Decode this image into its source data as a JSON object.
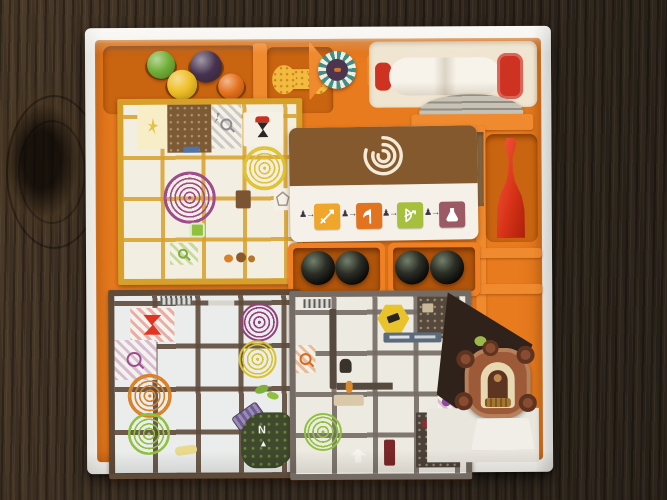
{
  "scene": {
    "description": "Magic Maze board game box interior with orange plastic insert, sitting on a dark wood table",
    "table_colors": {
      "base": "#3c3023",
      "grain_dark": "#221a13",
      "grain_light": "#4c3b29"
    },
    "box_colors": {
      "rim": "#f5f3ee",
      "floor": "#e9e6de"
    },
    "insert_colors": {
      "base": "#e87b1e",
      "wall": "#f08a2e",
      "recess": "#c96410"
    }
  },
  "inventory": {
    "hero_pawns": [
      "green",
      "purple",
      "yellow",
      "orange"
    ],
    "tokens": [
      "bone-shaped token",
      "striped round token",
      "stack of grey discs",
      "4 black dome tokens"
    ],
    "timer": "large sand timer with red caps",
    "large_pawn": "red wooden pawn",
    "card": "vortex card with four hero-item slots",
    "tiles": [
      "yellow mall tile",
      "brown mall tile",
      "grey mall tile"
    ],
    "standee": "ornate cardboard shop standee on white base"
  },
  "pawn_colors": {
    "green": "#6fae35",
    "purple": "#46324e",
    "yellow": "#eebd24",
    "orange": "#e4701c"
  },
  "red_pawn": {
    "color": "#d83318"
  },
  "timer": {
    "cap_color": "#ce3322",
    "glass_color": "#f7f3ea"
  },
  "tokens": {
    "bone": "#f2bb40",
    "round_ring": "#3f8f89",
    "round_core": "#4d3550",
    "dome": "#0a0a08",
    "discs": "#c7c2b6"
  },
  "action_card": {
    "top_color": "#84592e",
    "spiral_color": "#f3ead8",
    "pawn_arrow": "♟→",
    "items": [
      {
        "icon": "sword-icon",
        "color": "#f0a52b"
      },
      {
        "icon": "axe-icon",
        "color": "#e2741f"
      },
      {
        "icon": "bow-icon",
        "color": "#a6bf3c"
      },
      {
        "icon": "flask-icon",
        "color": "#9c5a64"
      }
    ]
  },
  "spiral_colors": {
    "a_yellow": "#dfc332",
    "a_purple": "#9d4b8d",
    "b_orange": "#d98127",
    "b_green": "#8fc13f",
    "b_purple": "#93407e",
    "b_yellow": "#d8c22f",
    "c_green": "#8fc13f"
  },
  "compass": {
    "label": "N"
  },
  "glyphs": {
    "compass_arrow": "▲"
  },
  "standee": {
    "deco_color": "#9c5a38",
    "arch_color": "#e8d8b2",
    "base_color": "#f0eee7"
  }
}
